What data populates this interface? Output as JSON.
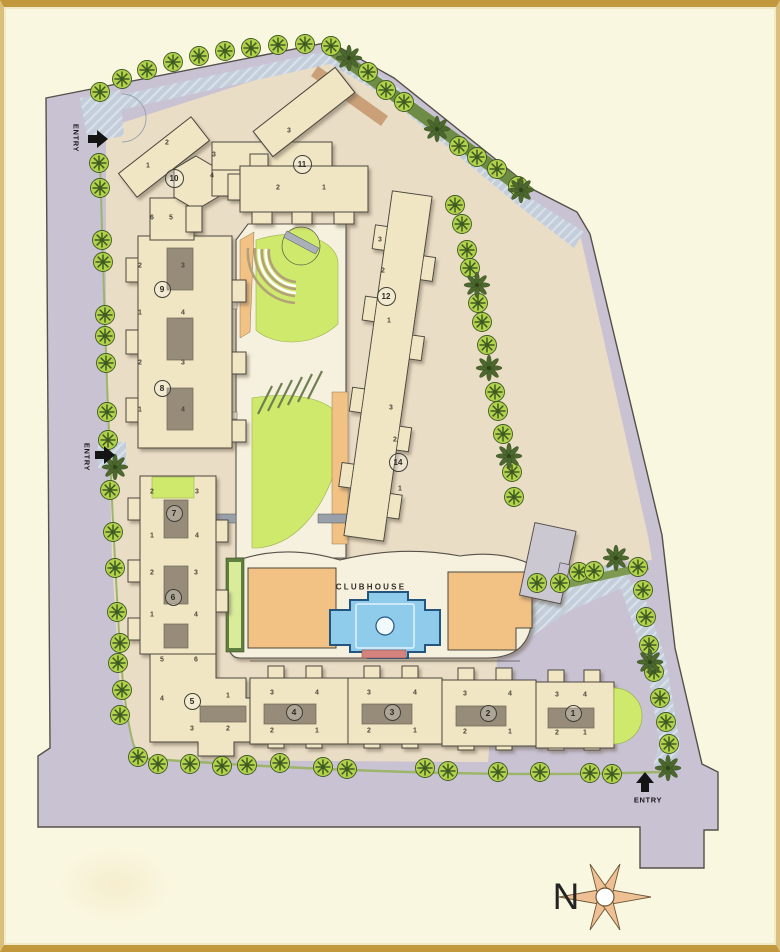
{
  "plan": {
    "title": "residential-site-plan",
    "clubhouse_label": "CLUBHOUSE",
    "north_label": "N",
    "entry_label": "ENTRY"
  },
  "labels": [
    {
      "name": "entry-label-top-left",
      "text": "ENTRY",
      "x": 76,
      "y": 138,
      "rot": 90,
      "cls": "entry"
    },
    {
      "name": "entry-label-mid-left",
      "text": "ENTRY",
      "x": 87,
      "y": 457,
      "rot": 90,
      "cls": "entry"
    },
    {
      "name": "entry-label-bottom-right",
      "text": "ENTRY",
      "x": 648,
      "y": 800,
      "rot": 0,
      "cls": "entry"
    },
    {
      "name": "clubhouse-label",
      "text": "CLUBHOUSE",
      "x": 371,
      "y": 587,
      "rot": 0,
      "cls": "clubhouse"
    },
    {
      "name": "north-label",
      "text": "N",
      "x": 566,
      "y": 897,
      "rot": 0,
      "cls": "north"
    }
  ],
  "buildings": [
    {
      "no": "1",
      "x": 573,
      "y": 713
    },
    {
      "no": "2",
      "x": 488,
      "y": 713
    },
    {
      "no": "3",
      "x": 392,
      "y": 712
    },
    {
      "no": "4",
      "x": 294,
      "y": 712
    },
    {
      "no": "5",
      "x": 192,
      "y": 701
    },
    {
      "no": "6",
      "x": 173,
      "y": 597
    },
    {
      "no": "7",
      "x": 174,
      "y": 513
    },
    {
      "no": "8",
      "x": 162,
      "y": 388
    },
    {
      "no": "9",
      "x": 162,
      "y": 289
    },
    {
      "no": "10",
      "x": 174,
      "y": 178
    },
    {
      "no": "11",
      "x": 302,
      "y": 164
    },
    {
      "no": "12",
      "x": 386,
      "y": 296
    },
    {
      "no": "14",
      "x": 398,
      "y": 462
    }
  ],
  "units": [
    {
      "t": "6",
      "x": 152,
      "y": 218
    },
    {
      "t": "5",
      "x": 171,
      "y": 218
    },
    {
      "t": "2",
      "x": 140,
      "y": 266
    },
    {
      "t": "3",
      "x": 183,
      "y": 266
    },
    {
      "t": "1",
      "x": 140,
      "y": 313
    },
    {
      "t": "4",
      "x": 183,
      "y": 313
    },
    {
      "t": "2",
      "x": 140,
      "y": 363
    },
    {
      "t": "3",
      "x": 183,
      "y": 363
    },
    {
      "t": "1",
      "x": 140,
      "y": 410
    },
    {
      "t": "4",
      "x": 183,
      "y": 410
    },
    {
      "t": "2",
      "x": 152,
      "y": 492
    },
    {
      "t": "3",
      "x": 197,
      "y": 492
    },
    {
      "t": "1",
      "x": 152,
      "y": 536
    },
    {
      "t": "4",
      "x": 197,
      "y": 536
    },
    {
      "t": "2",
      "x": 152,
      "y": 573
    },
    {
      "t": "3",
      "x": 196,
      "y": 573
    },
    {
      "t": "1",
      "x": 152,
      "y": 615
    },
    {
      "t": "4",
      "x": 196,
      "y": 615
    },
    {
      "t": "5",
      "x": 162,
      "y": 660
    },
    {
      "t": "6",
      "x": 196,
      "y": 660
    },
    {
      "t": "4",
      "x": 162,
      "y": 699
    },
    {
      "t": "1",
      "x": 228,
      "y": 696
    },
    {
      "t": "3",
      "x": 192,
      "y": 729
    },
    {
      "t": "2",
      "x": 228,
      "y": 729
    },
    {
      "t": "3",
      "x": 272,
      "y": 693
    },
    {
      "t": "4",
      "x": 317,
      "y": 693
    },
    {
      "t": "2",
      "x": 272,
      "y": 731
    },
    {
      "t": "1",
      "x": 317,
      "y": 731
    },
    {
      "t": "3",
      "x": 369,
      "y": 693
    },
    {
      "t": "4",
      "x": 415,
      "y": 693
    },
    {
      "t": "2",
      "x": 369,
      "y": 731
    },
    {
      "t": "1",
      "x": 415,
      "y": 731
    },
    {
      "t": "3",
      "x": 465,
      "y": 694
    },
    {
      "t": "4",
      "x": 510,
      "y": 694
    },
    {
      "t": "2",
      "x": 465,
      "y": 732
    },
    {
      "t": "1",
      "x": 510,
      "y": 732
    },
    {
      "t": "3",
      "x": 557,
      "y": 695
    },
    {
      "t": "4",
      "x": 585,
      "y": 695
    },
    {
      "t": "2",
      "x": 557,
      "y": 733
    },
    {
      "t": "1",
      "x": 585,
      "y": 733
    },
    {
      "t": "2",
      "x": 167,
      "y": 143
    },
    {
      "t": "1",
      "x": 148,
      "y": 166
    },
    {
      "t": "3",
      "x": 214,
      "y": 155
    },
    {
      "t": "4",
      "x": 212,
      "y": 176
    },
    {
      "t": "3",
      "x": 289,
      "y": 131
    },
    {
      "t": "2",
      "x": 278,
      "y": 188
    },
    {
      "t": "1",
      "x": 324,
      "y": 188
    },
    {
      "t": "3",
      "x": 380,
      "y": 240
    },
    {
      "t": "2",
      "x": 383,
      "y": 271
    },
    {
      "t": "1",
      "x": 389,
      "y": 321
    },
    {
      "t": "3",
      "x": 391,
      "y": 408
    },
    {
      "t": "2",
      "x": 395,
      "y": 440
    },
    {
      "t": "1",
      "x": 400,
      "y": 489
    }
  ],
  "trees": {
    "round": [
      [
        100,
        92
      ],
      [
        122,
        79
      ],
      [
        147,
        70
      ],
      [
        173,
        62
      ],
      [
        199,
        56
      ],
      [
        225,
        51
      ],
      [
        251,
        48
      ],
      [
        278,
        45
      ],
      [
        305,
        44
      ],
      [
        331,
        46
      ],
      [
        368,
        72
      ],
      [
        386,
        90
      ],
      [
        404,
        102
      ],
      [
        459,
        146
      ],
      [
        477,
        157
      ],
      [
        497,
        169
      ],
      [
        518,
        186
      ],
      [
        455,
        205
      ],
      [
        462,
        224
      ],
      [
        467,
        250
      ],
      [
        470,
        268
      ],
      [
        478,
        303
      ],
      [
        482,
        322
      ],
      [
        487,
        345
      ],
      [
        495,
        392
      ],
      [
        498,
        411
      ],
      [
        503,
        434
      ],
      [
        512,
        472
      ],
      [
        514,
        497
      ],
      [
        537,
        583
      ],
      [
        560,
        583
      ],
      [
        579,
        572
      ],
      [
        594,
        571
      ],
      [
        638,
        567
      ],
      [
        643,
        590
      ],
      [
        646,
        617
      ],
      [
        649,
        645
      ],
      [
        654,
        672
      ],
      [
        660,
        698
      ],
      [
        666,
        722
      ],
      [
        669,
        744
      ],
      [
        612,
        774
      ],
      [
        590,
        773
      ],
      [
        540,
        772
      ],
      [
        498,
        772
      ],
      [
        448,
        771
      ],
      [
        425,
        768
      ],
      [
        347,
        769
      ],
      [
        323,
        767
      ],
      [
        280,
        763
      ],
      [
        247,
        765
      ],
      [
        222,
        766
      ],
      [
        190,
        764
      ],
      [
        158,
        764
      ],
      [
        138,
        757
      ],
      [
        122,
        690
      ],
      [
        120,
        715
      ],
      [
        118,
        663
      ],
      [
        120,
        643
      ],
      [
        117,
        612
      ],
      [
        115,
        568
      ],
      [
        113,
        532
      ],
      [
        110,
        490
      ],
      [
        108,
        440
      ],
      [
        107,
        412
      ],
      [
        106,
        363
      ],
      [
        105,
        336
      ],
      [
        105,
        315
      ],
      [
        103,
        262
      ],
      [
        102,
        240
      ],
      [
        100,
        188
      ],
      [
        99,
        163
      ]
    ],
    "palm": [
      [
        349,
        58
      ],
      [
        437,
        129
      ],
      [
        521,
        190
      ],
      [
        477,
        285
      ],
      [
        489,
        368
      ],
      [
        509,
        456
      ],
      [
        616,
        558
      ],
      [
        650,
        662
      ],
      [
        668,
        768
      ],
      [
        115,
        467
      ]
    ]
  },
  "colors": {
    "paper_cream": "#FAF7E1",
    "frame_gold": "#C2983C",
    "site_lavender": "#C9C2D3",
    "court_beige": "#EADDC6",
    "building_fill": "#F0E6C4",
    "building_outline": "#4b463c",
    "road_blue": "#C3CEDA",
    "hedge_green": "#6E8C46",
    "lawn_green": "#CEE96C",
    "tree_green": "#B2D24C",
    "tree_dark": "#3E5A22",
    "path_orange": "#F2C184",
    "pool_blue": "#8FCBEA",
    "pool_border": "#23557F",
    "parking_gray": "#CBC8D2",
    "compass_tan": "#EFC093",
    "entry_arrow_black": "#141414",
    "pool_deck_red": "#D4847C"
  }
}
